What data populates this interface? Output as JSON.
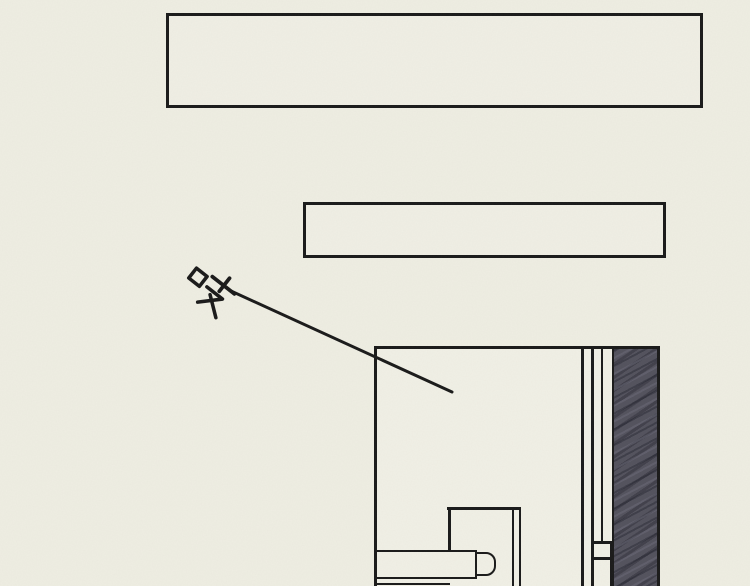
{
  "sfx": {
    "text": "吱"
  },
  "caption_boxes": [
    {
      "text": ""
    },
    {
      "text": ""
    }
  ],
  "colors": {
    "background": "#EFEEE3",
    "ink": "#1A1A1A",
    "panel_fill": "#F1F0E6",
    "box_fill": "#F0EFE5",
    "shade_base": "#53525D",
    "shade_dark": "#3F3E49",
    "shade_light": "#6B6A75"
  }
}
